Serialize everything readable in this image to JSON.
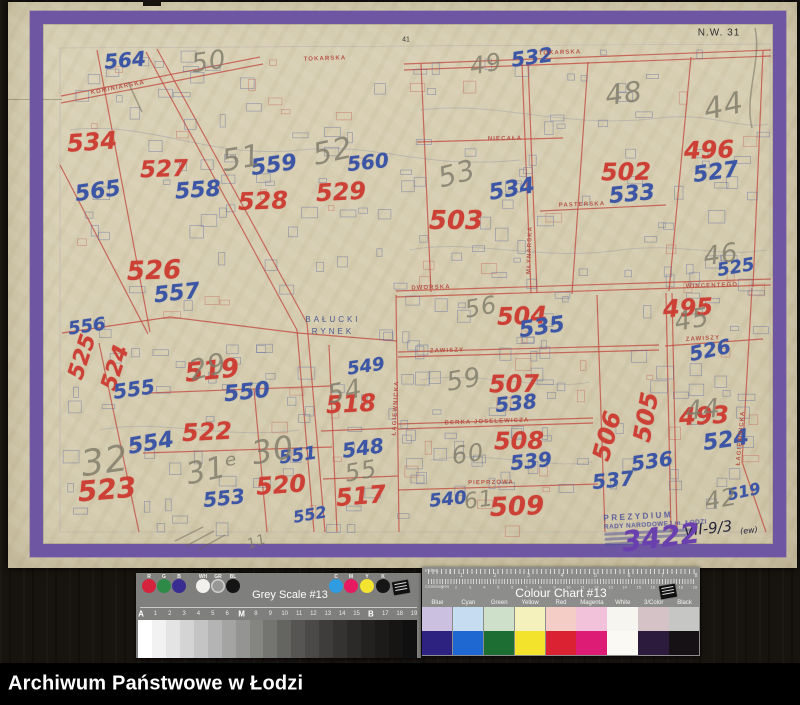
{
  "archive_bar": {
    "label": "Archiwum Państwowe w Łodzi"
  },
  "map_sheet": {
    "corner_code": "N.W. 31",
    "edge_tick": "41",
    "place_label": {
      "line1": "BAŁUCKI",
      "line2": "RYNEK",
      "x": 333,
      "y": 326
    },
    "stamp": {
      "line1": "PREZYDIUM",
      "line2": "RADY NARODOWEJ m. ŁODZI"
    },
    "annotations": {
      "inventory_number": "VII-9/3",
      "inventory_suffix": "(ew)",
      "purple_number": "3422"
    },
    "street_labels": [
      {
        "t": "KOMINIARSKA",
        "x": 118,
        "y": 88,
        "r": -11
      },
      {
        "t": "TOKARSKA",
        "x": 325,
        "y": 59,
        "r": -2
      },
      {
        "t": "TOKARSKA",
        "x": 560,
        "y": 53,
        "r": -2
      },
      {
        "t": "NIECAŁA",
        "x": 505,
        "y": 139,
        "r": -1
      },
      {
        "t": "PASTERSKA",
        "x": 582,
        "y": 205,
        "r": -2
      },
      {
        "t": "MŁYNARSKA",
        "x": 530,
        "y": 250,
        "r": -88
      },
      {
        "t": "DWORSKA",
        "x": 431,
        "y": 288,
        "r": -2
      },
      {
        "t": "WINCENTEGO",
        "x": 712,
        "y": 286,
        "r": -2
      },
      {
        "t": "ZAWISZY",
        "x": 447,
        "y": 351,
        "r": -2
      },
      {
        "t": "ZAWISZY",
        "x": 703,
        "y": 339,
        "r": -3
      },
      {
        "t": "BERKA JOSELEWICZA",
        "x": 487,
        "y": 422,
        "r": -2
      },
      {
        "t": "PIEPRZOWA",
        "x": 491,
        "y": 483,
        "r": -1
      },
      {
        "t": "ŁAGIEWNICKA",
        "x": 396,
        "y": 408,
        "r": -87
      },
      {
        "t": "ŁAGIEWNICKA",
        "x": 741,
        "y": 438,
        "r": -85
      }
    ],
    "plot_numbers": [
      {
        "t": "534",
        "c": "red",
        "x": 92,
        "y": 142,
        "s": 24,
        "r": -4
      },
      {
        "t": "527",
        "c": "red",
        "x": 164,
        "y": 170,
        "s": 23,
        "r": -2
      },
      {
        "t": "528",
        "c": "red",
        "x": 263,
        "y": 201,
        "s": 24,
        "r": -2
      },
      {
        "t": "529",
        "c": "red",
        "x": 341,
        "y": 192,
        "s": 24,
        "r": -3
      },
      {
        "t": "526",
        "c": "red",
        "x": 154,
        "y": 271,
        "s": 26,
        "r": -2
      },
      {
        "t": "502",
        "c": "red",
        "x": 626,
        "y": 172,
        "s": 24,
        "r": -1
      },
      {
        "t": "496",
        "c": "red",
        "x": 709,
        "y": 150,
        "s": 24,
        "r": -2
      },
      {
        "t": "503",
        "c": "red",
        "x": 456,
        "y": 221,
        "s": 26,
        "r": 0
      },
      {
        "t": "525",
        "c": "red",
        "x": 83,
        "y": 357,
        "s": 22,
        "r": -72
      },
      {
        "t": "524",
        "c": "red",
        "x": 116,
        "y": 368,
        "s": 22,
        "r": -72
      },
      {
        "t": "519",
        "c": "red",
        "x": 212,
        "y": 371,
        "s": 26,
        "r": -6
      },
      {
        "t": "518",
        "c": "red",
        "x": 351,
        "y": 404,
        "s": 24,
        "r": -3
      },
      {
        "t": "522",
        "c": "red",
        "x": 207,
        "y": 432,
        "s": 24,
        "r": -3
      },
      {
        "t": "523",
        "c": "red",
        "x": 107,
        "y": 490,
        "s": 28,
        "r": -5
      },
      {
        "t": "520",
        "c": "red",
        "x": 281,
        "y": 485,
        "s": 24,
        "r": -4
      },
      {
        "t": "517",
        "c": "red",
        "x": 361,
        "y": 496,
        "s": 24,
        "r": -5
      },
      {
        "t": "504",
        "c": "red",
        "x": 522,
        "y": 316,
        "s": 24,
        "r": -2
      },
      {
        "t": "495",
        "c": "red",
        "x": 688,
        "y": 308,
        "s": 24,
        "r": -3
      },
      {
        "t": "507",
        "c": "red",
        "x": 514,
        "y": 384,
        "s": 24,
        "r": -1
      },
      {
        "t": "508",
        "c": "red",
        "x": 519,
        "y": 441,
        "s": 24,
        "r": -1
      },
      {
        "t": "509",
        "c": "red",
        "x": 517,
        "y": 507,
        "s": 26,
        "r": -2
      },
      {
        "t": "505",
        "c": "red",
        "x": 646,
        "y": 417,
        "s": 24,
        "r": -80
      },
      {
        "t": "506",
        "c": "red",
        "x": 607,
        "y": 436,
        "s": 24,
        "r": -75
      },
      {
        "t": "493",
        "c": "red",
        "x": 704,
        "y": 416,
        "s": 24,
        "r": -3
      },
      {
        "t": "564",
        "c": "blue",
        "x": 125,
        "y": 60,
        "s": 20,
        "r": -5
      },
      {
        "t": "565",
        "c": "blue",
        "x": 98,
        "y": 192,
        "s": 22,
        "r": -8
      },
      {
        "t": "558",
        "c": "blue",
        "x": 198,
        "y": 191,
        "s": 22,
        "r": -4
      },
      {
        "t": "559",
        "c": "blue",
        "x": 274,
        "y": 166,
        "s": 22,
        "r": -8
      },
      {
        "t": "560",
        "c": "blue",
        "x": 368,
        "y": 162,
        "s": 20,
        "r": -6
      },
      {
        "t": "557",
        "c": "blue",
        "x": 177,
        "y": 294,
        "s": 22,
        "r": -6
      },
      {
        "t": "532",
        "c": "blue",
        "x": 532,
        "y": 57,
        "s": 20,
        "r": -8
      },
      {
        "t": "533",
        "c": "blue",
        "x": 632,
        "y": 195,
        "s": 22,
        "r": -5
      },
      {
        "t": "534",
        "c": "blue",
        "x": 512,
        "y": 190,
        "s": 22,
        "r": -10
      },
      {
        "t": "527",
        "c": "blue",
        "x": 716,
        "y": 173,
        "s": 22,
        "r": -8
      },
      {
        "t": "525",
        "c": "blue",
        "x": 736,
        "y": 268,
        "s": 18,
        "r": -10
      },
      {
        "t": "526",
        "c": "blue",
        "x": 710,
        "y": 350,
        "s": 20,
        "r": -12
      },
      {
        "t": "556",
        "c": "blue",
        "x": 87,
        "y": 327,
        "s": 18,
        "r": -8
      },
      {
        "t": "555",
        "c": "blue",
        "x": 134,
        "y": 389,
        "s": 20,
        "r": -8
      },
      {
        "t": "550",
        "c": "blue",
        "x": 247,
        "y": 393,
        "s": 22,
        "r": -6
      },
      {
        "t": "549",
        "c": "blue",
        "x": 366,
        "y": 367,
        "s": 18,
        "r": -8
      },
      {
        "t": "554",
        "c": "blue",
        "x": 151,
        "y": 444,
        "s": 22,
        "r": -10
      },
      {
        "t": "553",
        "c": "blue",
        "x": 224,
        "y": 498,
        "s": 20,
        "r": -6
      },
      {
        "t": "551",
        "c": "blue",
        "x": 298,
        "y": 456,
        "s": 18,
        "r": -8
      },
      {
        "t": "552",
        "c": "blue",
        "x": 310,
        "y": 515,
        "s": 16,
        "r": -10
      },
      {
        "t": "548",
        "c": "blue",
        "x": 363,
        "y": 448,
        "s": 20,
        "r": -8
      },
      {
        "t": "535",
        "c": "blue",
        "x": 542,
        "y": 328,
        "s": 22,
        "r": -8
      },
      {
        "t": "538",
        "c": "blue",
        "x": 516,
        "y": 403,
        "s": 20,
        "r": -6
      },
      {
        "t": "539",
        "c": "blue",
        "x": 531,
        "y": 461,
        "s": 20,
        "r": -6
      },
      {
        "t": "540",
        "c": "blue",
        "x": 448,
        "y": 500,
        "s": 18,
        "r": -6
      },
      {
        "t": "536",
        "c": "blue",
        "x": 652,
        "y": 461,
        "s": 20,
        "r": -8
      },
      {
        "t": "537",
        "c": "blue",
        "x": 613,
        "y": 480,
        "s": 20,
        "r": -6
      },
      {
        "t": "524",
        "c": "blue",
        "x": 726,
        "y": 441,
        "s": 22,
        "r": -8
      },
      {
        "t": "519",
        "c": "blue",
        "x": 744,
        "y": 492,
        "s": 16,
        "r": -12
      },
      {
        "t": "50",
        "c": "pencil",
        "x": 209,
        "y": 62,
        "s": 26,
        "r": -8
      },
      {
        "t": "49",
        "c": "pencil",
        "x": 486,
        "y": 64,
        "s": 24,
        "r": -10
      },
      {
        "t": "48",
        "c": "pencil",
        "x": 624,
        "y": 94,
        "s": 28,
        "r": -8
      },
      {
        "t": "44",
        "c": "pencil",
        "x": 724,
        "y": 107,
        "s": 30,
        "r": -12
      },
      {
        "t": "51",
        "c": "pencil",
        "x": 242,
        "y": 159,
        "s": 30,
        "r": -10
      },
      {
        "t": "52",
        "c": "pencil",
        "x": 333,
        "y": 152,
        "s": 30,
        "r": -12
      },
      {
        "t": "53",
        "c": "pencil",
        "x": 457,
        "y": 174,
        "s": 28,
        "r": -15
      },
      {
        "t": "45",
        "c": "pencil",
        "x": 692,
        "y": 320,
        "s": 26,
        "r": -10
      },
      {
        "t": "46",
        "c": "pencil",
        "x": 721,
        "y": 255,
        "s": 26,
        "r": -8
      },
      {
        "t": "56",
        "c": "pencil",
        "x": 481,
        "y": 307,
        "s": 24,
        "r": -10
      },
      {
        "t": "59",
        "c": "pencil",
        "x": 464,
        "y": 380,
        "s": 26,
        "r": -10
      },
      {
        "t": "60",
        "c": "pencil",
        "x": 468,
        "y": 454,
        "s": 24,
        "r": -8
      },
      {
        "t": "61",
        "c": "pencil",
        "x": 479,
        "y": 501,
        "s": 22,
        "r": -8
      },
      {
        "t": "32",
        "c": "pencil",
        "x": 105,
        "y": 462,
        "s": 36,
        "r": -8
      },
      {
        "t": "31ᵉ",
        "c": "pencil",
        "x": 213,
        "y": 470,
        "s": 30,
        "r": -12
      },
      {
        "t": "30",
        "c": "pencil",
        "x": 273,
        "y": 450,
        "s": 32,
        "r": -10
      },
      {
        "t": "29",
        "c": "pencil",
        "x": 208,
        "y": 367,
        "s": 28,
        "r": -15
      },
      {
        "t": "54",
        "c": "pencil",
        "x": 345,
        "y": 392,
        "s": 26,
        "r": -12
      },
      {
        "t": "55",
        "c": "pencil",
        "x": 361,
        "y": 471,
        "s": 24,
        "r": -10
      },
      {
        "t": "42",
        "c": "pencil",
        "x": 721,
        "y": 499,
        "s": 24,
        "r": -10
      },
      {
        "t": "44",
        "c": "pencil",
        "x": 703,
        "y": 410,
        "s": 26,
        "r": -5
      },
      {
        "t": "11",
        "c": "pencil",
        "x": 257,
        "y": 542,
        "s": 14,
        "r": -20
      }
    ]
  },
  "grey_scale_card": {
    "title": "Grey Scale #13",
    "left_dots": [
      {
        "label": "R",
        "color": "#d5233c"
      },
      {
        "label": "G",
        "color": "#2e8b47"
      },
      {
        "label": "B",
        "color": "#3a2d91"
      },
      {
        "label": "WH",
        "color": "#f2f0ec"
      },
      {
        "label": "GR",
        "color": "#989896",
        "ring": true
      },
      {
        "label": "BL",
        "color": "#141414"
      }
    ],
    "right_dots": [
      {
        "label": "C",
        "color": "#2f9ce2"
      },
      {
        "label": "M",
        "color": "#e61a60"
      },
      {
        "label": "Y",
        "color": "#f2e431"
      },
      {
        "label": "K",
        "color": "#161616"
      }
    ],
    "scale_labels": [
      "A",
      "1",
      "2",
      "3",
      "4",
      "5",
      "6",
      "M",
      "8",
      "9",
      "10",
      "11",
      "12",
      "13",
      "14",
      "15",
      "B",
      "17",
      "18",
      "19"
    ],
    "wedge_steps": [
      "#ffffff",
      "#f2f2f2",
      "#e4e4e4",
      "#d4d4d4",
      "#c4c4c4",
      "#b4b4b4",
      "#a4a4a2",
      "#949492",
      "#848481",
      "#747471",
      "#646461",
      "#565553",
      "#4a4947",
      "#3e3d3b",
      "#343331",
      "#2b2a28",
      "#232220",
      "#1c1b1a",
      "#161514",
      "#111010"
    ]
  },
  "colour_chart_card": {
    "title": "Colour Chart #13",
    "ruler_top_label": "Inches",
    "ruler_bottom_label": "Centimetres",
    "columns": [
      {
        "label": "Blue",
        "light": "#cbc0e0",
        "dark": "#2e2280"
      },
      {
        "label": "Cyan",
        "light": "#c6ddf1",
        "dark": "#1f68d2"
      },
      {
        "label": "Green",
        "light": "#cedfca",
        "dark": "#1d6e33"
      },
      {
        "label": "Yellow",
        "light": "#f4f1bd",
        "dark": "#f3e32d"
      },
      {
        "label": "Red",
        "light": "#f3cdc6",
        "dark": "#da2232"
      },
      {
        "label": "Magenta",
        "light": "#f1c2da",
        "dark": "#dd1d75"
      },
      {
        "label": "White",
        "light": "#f7f5f0",
        "dark": "#fbf9f4"
      },
      {
        "label": "3/Color",
        "light": "#d5c2c6",
        "dark": "#2c1b3c"
      },
      {
        "label": "Black",
        "light": "#c6c6c4",
        "dark": "#151114"
      }
    ]
  }
}
